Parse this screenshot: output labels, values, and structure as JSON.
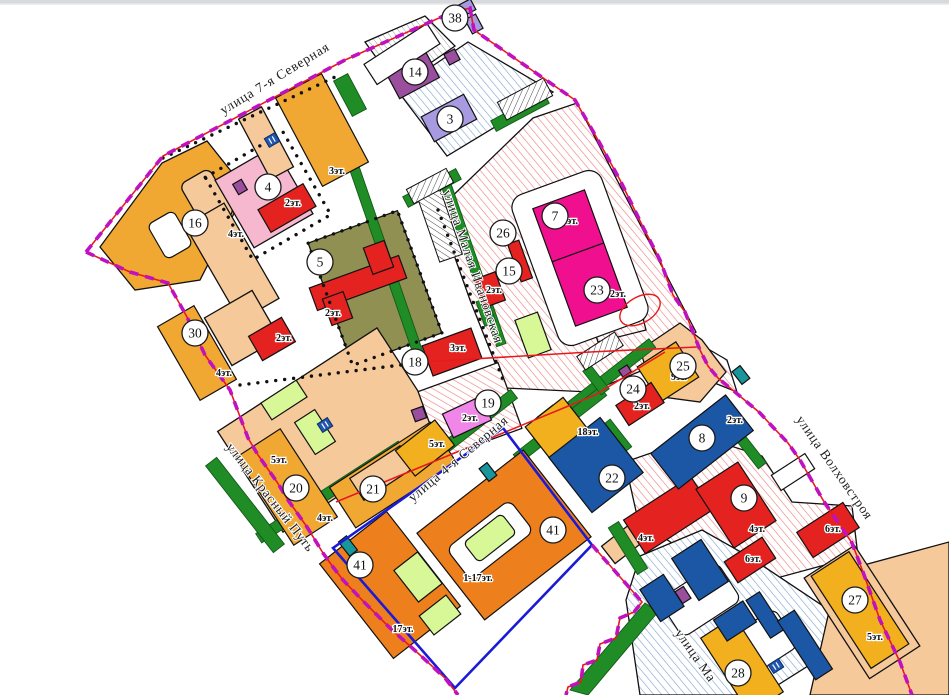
{
  "canvas": {
    "width": 949,
    "height": 695,
    "background": "#ffffff"
  },
  "palette": {
    "boundary_magenta": "#c011c0",
    "boundary_red": "#e8191c",
    "boundary_blue": "#1b1bd6",
    "green_strip": "#1f8c25",
    "olive_parcel": "#8f9052",
    "peach_parcel": "#f6c99a",
    "yellow_building": "#f0a832",
    "golden_building": "#f2b01e",
    "orange_building": "#ee7f1d",
    "red_building": "#e42320",
    "magenta_building": "#f00f8e",
    "purple_building": "#9a4f9e",
    "lavender_building": "#a79ae0",
    "orchid_building": "#ef86e8",
    "pink_parcel": "#f6b8cf",
    "blue_building": "#1c57a5",
    "teal_building": "#18969b",
    "light_green_building": "#d8f898",
    "hatch_red_line": "#ef8585",
    "hatch_blue_line": "#85a8d0"
  },
  "streets": [
    {
      "name": "ulitsa-7-ya-severnaya",
      "label": "улица 7-я Северная",
      "x": 277,
      "y": 82,
      "angle": -31.5
    },
    {
      "name": "ulitsa-malaya-ivanovskaya",
      "label": "улица Малая Ивановская",
      "x": 469,
      "y": 268,
      "angle": 71
    },
    {
      "name": "ulitsa-4-ya-severnaya",
      "label": "улица 4-я Северная",
      "x": 461,
      "y": 462,
      "angle": -40
    },
    {
      "name": "ulitsa-krasnyy-put",
      "label": "улица Красный Путь",
      "x": 267,
      "y": 500,
      "angle": 52
    },
    {
      "name": "ulitsa-volkhovstroya",
      "label": "улица Волховстроя",
      "x": 831,
      "y": 470,
      "angle": 55
    },
    {
      "name": "ulitsa-ma",
      "label": "улица Ма",
      "x": 692,
      "y": 658,
      "angle": 55
    }
  ],
  "markers": [
    {
      "label": "38",
      "x": 455,
      "y": 18
    },
    {
      "label": "14",
      "x": 415,
      "y": 72
    },
    {
      "label": "3",
      "x": 450,
      "y": 119
    },
    {
      "label": "4",
      "x": 268,
      "y": 187
    },
    {
      "label": "16",
      "x": 195,
      "y": 223
    },
    {
      "label": "7",
      "x": 555,
      "y": 216
    },
    {
      "label": "26",
      "x": 503,
      "y": 233
    },
    {
      "label": "5",
      "x": 320,
      "y": 262
    },
    {
      "label": "15",
      "x": 509,
      "y": 271
    },
    {
      "label": "23",
      "x": 597,
      "y": 290
    },
    {
      "label": "30",
      "x": 195,
      "y": 333
    },
    {
      "label": "18",
      "x": 415,
      "y": 362
    },
    {
      "label": "25",
      "x": 683,
      "y": 366
    },
    {
      "label": "24",
      "x": 633,
      "y": 389
    },
    {
      "label": "19",
      "x": 488,
      "y": 403
    },
    {
      "label": "8",
      "x": 702,
      "y": 438
    },
    {
      "label": "22",
      "x": 612,
      "y": 478
    },
    {
      "label": "20",
      "x": 296,
      "y": 488
    },
    {
      "label": "21",
      "x": 373,
      "y": 489
    },
    {
      "label": "9",
      "x": 744,
      "y": 498
    },
    {
      "label": "41",
      "x": 553,
      "y": 530
    },
    {
      "label": "41",
      "x": 360,
      "y": 565
    },
    {
      "label": "27",
      "x": 855,
      "y": 600
    },
    {
      "label": "28",
      "x": 738,
      "y": 673
    }
  ],
  "floor_labels": [
    {
      "text": "3эт.",
      "x": 337,
      "y": 174
    },
    {
      "text": "2эт.",
      "x": 293,
      "y": 206
    },
    {
      "text": "4эт.",
      "x": 236,
      "y": 237
    },
    {
      "text": "2эт.",
      "x": 333,
      "y": 316
    },
    {
      "text": "2эт.",
      "x": 284,
      "y": 341
    },
    {
      "text": "4эт.",
      "x": 224,
      "y": 376
    },
    {
      "text": "2эт.",
      "x": 570,
      "y": 224
    },
    {
      "text": "2эт.",
      "x": 618,
      "y": 297
    },
    {
      "text": "2эт.",
      "x": 494,
      "y": 293
    },
    {
      "text": "3эт.",
      "x": 458,
      "y": 351
    },
    {
      "text": "2эт.",
      "x": 470,
      "y": 421
    },
    {
      "text": "5эт.",
      "x": 437,
      "y": 447
    },
    {
      "text": "9эт.",
      "x": 679,
      "y": 380
    },
    {
      "text": "2эт.",
      "x": 642,
      "y": 409
    },
    {
      "text": "2эт.",
      "x": 735,
      "y": 423
    },
    {
      "text": "18эт.",
      "x": 588,
      "y": 435
    },
    {
      "text": "5эт.",
      "x": 279,
      "y": 463
    },
    {
      "text": "4эт.",
      "x": 325,
      "y": 521
    },
    {
      "text": "1-17эт.",
      "x": 478,
      "y": 581
    },
    {
      "text": "17эт.",
      "x": 403,
      "y": 632
    },
    {
      "text": "4эт.",
      "x": 646,
      "y": 541
    },
    {
      "text": "4эт.",
      "x": 757,
      "y": 532
    },
    {
      "text": "6эт.",
      "x": 753,
      "y": 562
    },
    {
      "text": "6эт.",
      "x": 833,
      "y": 532
    },
    {
      "text": "5эт.",
      "x": 875,
      "y": 640
    }
  ],
  "substation_icons": [
    {
      "x": 272,
      "y": 140,
      "angle": -30
    },
    {
      "x": 325,
      "y": 425,
      "angle": -33
    },
    {
      "x": 776,
      "y": 666,
      "angle": -33
    }
  ]
}
